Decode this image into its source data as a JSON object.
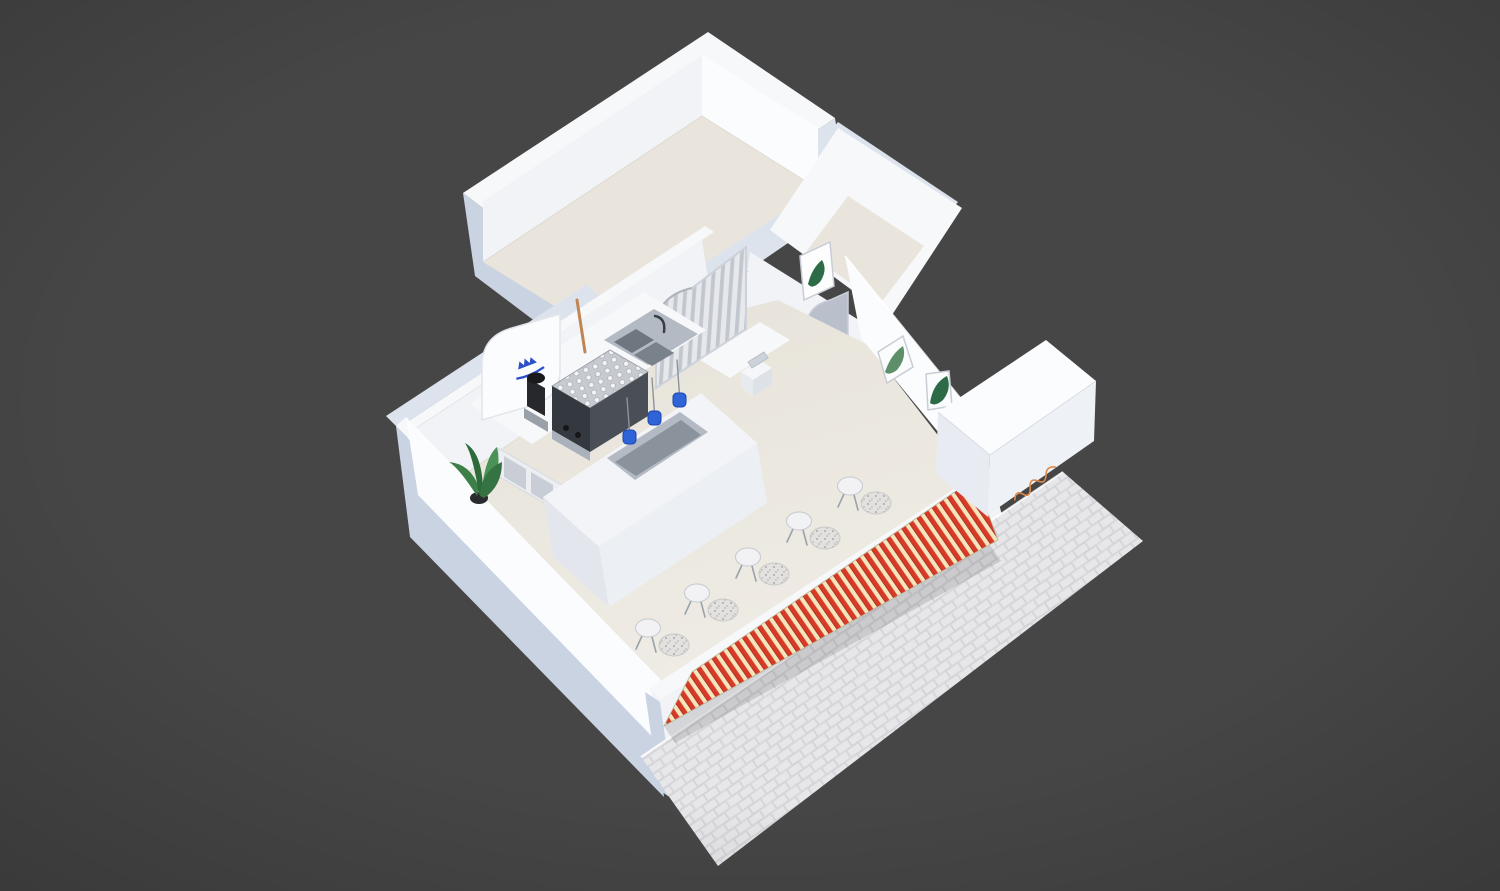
{
  "meta": {
    "scene": "isometric-cafe-interior-render",
    "view": "top-down axonometric cutaway of a small coffee shop model on dark backdrop"
  },
  "colors": {
    "background": "#464646",
    "vignette": "#3d3d3d",
    "wall_white": "#f7f8fa",
    "wall_face": "#f1f3f7",
    "wall_bright": "#fbfcfe",
    "wall_shadow": "#dde3ed",
    "exterior_blue": "#c9d3e2",
    "floor_beige": "#e9e5dc",
    "floor_back_room": "#eae5dc",
    "steel": "#b3bac3",
    "steel_dark": "#79818b",
    "trough_gray": "#8a929c",
    "awning_red": "#d83a28",
    "awning_cream": "#f3e6bd",
    "sidewalk": "#e7e7ea",
    "sidewalk_line": "#d2d2d7",
    "plant_green": "#3c8048",
    "plant_green_dark": "#2e6b3a",
    "logo_blue": "#2b50c8",
    "signage_orange": "#e08a4a",
    "appliance_black": "#26282c",
    "appliance_side": "#4a4f57",
    "curtain_light": "#e6e8ec",
    "curtain_dark": "#c2c6ce",
    "terrazzo": "#e2e1df",
    "terrazzo_dot": "#9a9a9a",
    "stool_white": "#f2f2f4",
    "print_green": "#2d6b46",
    "opening_shade": "#b9c0cb"
  },
  "objects": {
    "rooms_visible": 4,
    "seating_pairs": 5,
    "island_taps": 3,
    "framed_leaf_prints": 3,
    "arched_openings": 2,
    "has_espresso_machine": true,
    "has_coffee_grinder": true,
    "has_double_sink": true,
    "has_curtain": true,
    "has_potted_plant": true,
    "has_striped_awning": true,
    "has_paved_sidewalk": true,
    "has_blue_brand_logo": true,
    "has_orange_script_signage": true
  }
}
